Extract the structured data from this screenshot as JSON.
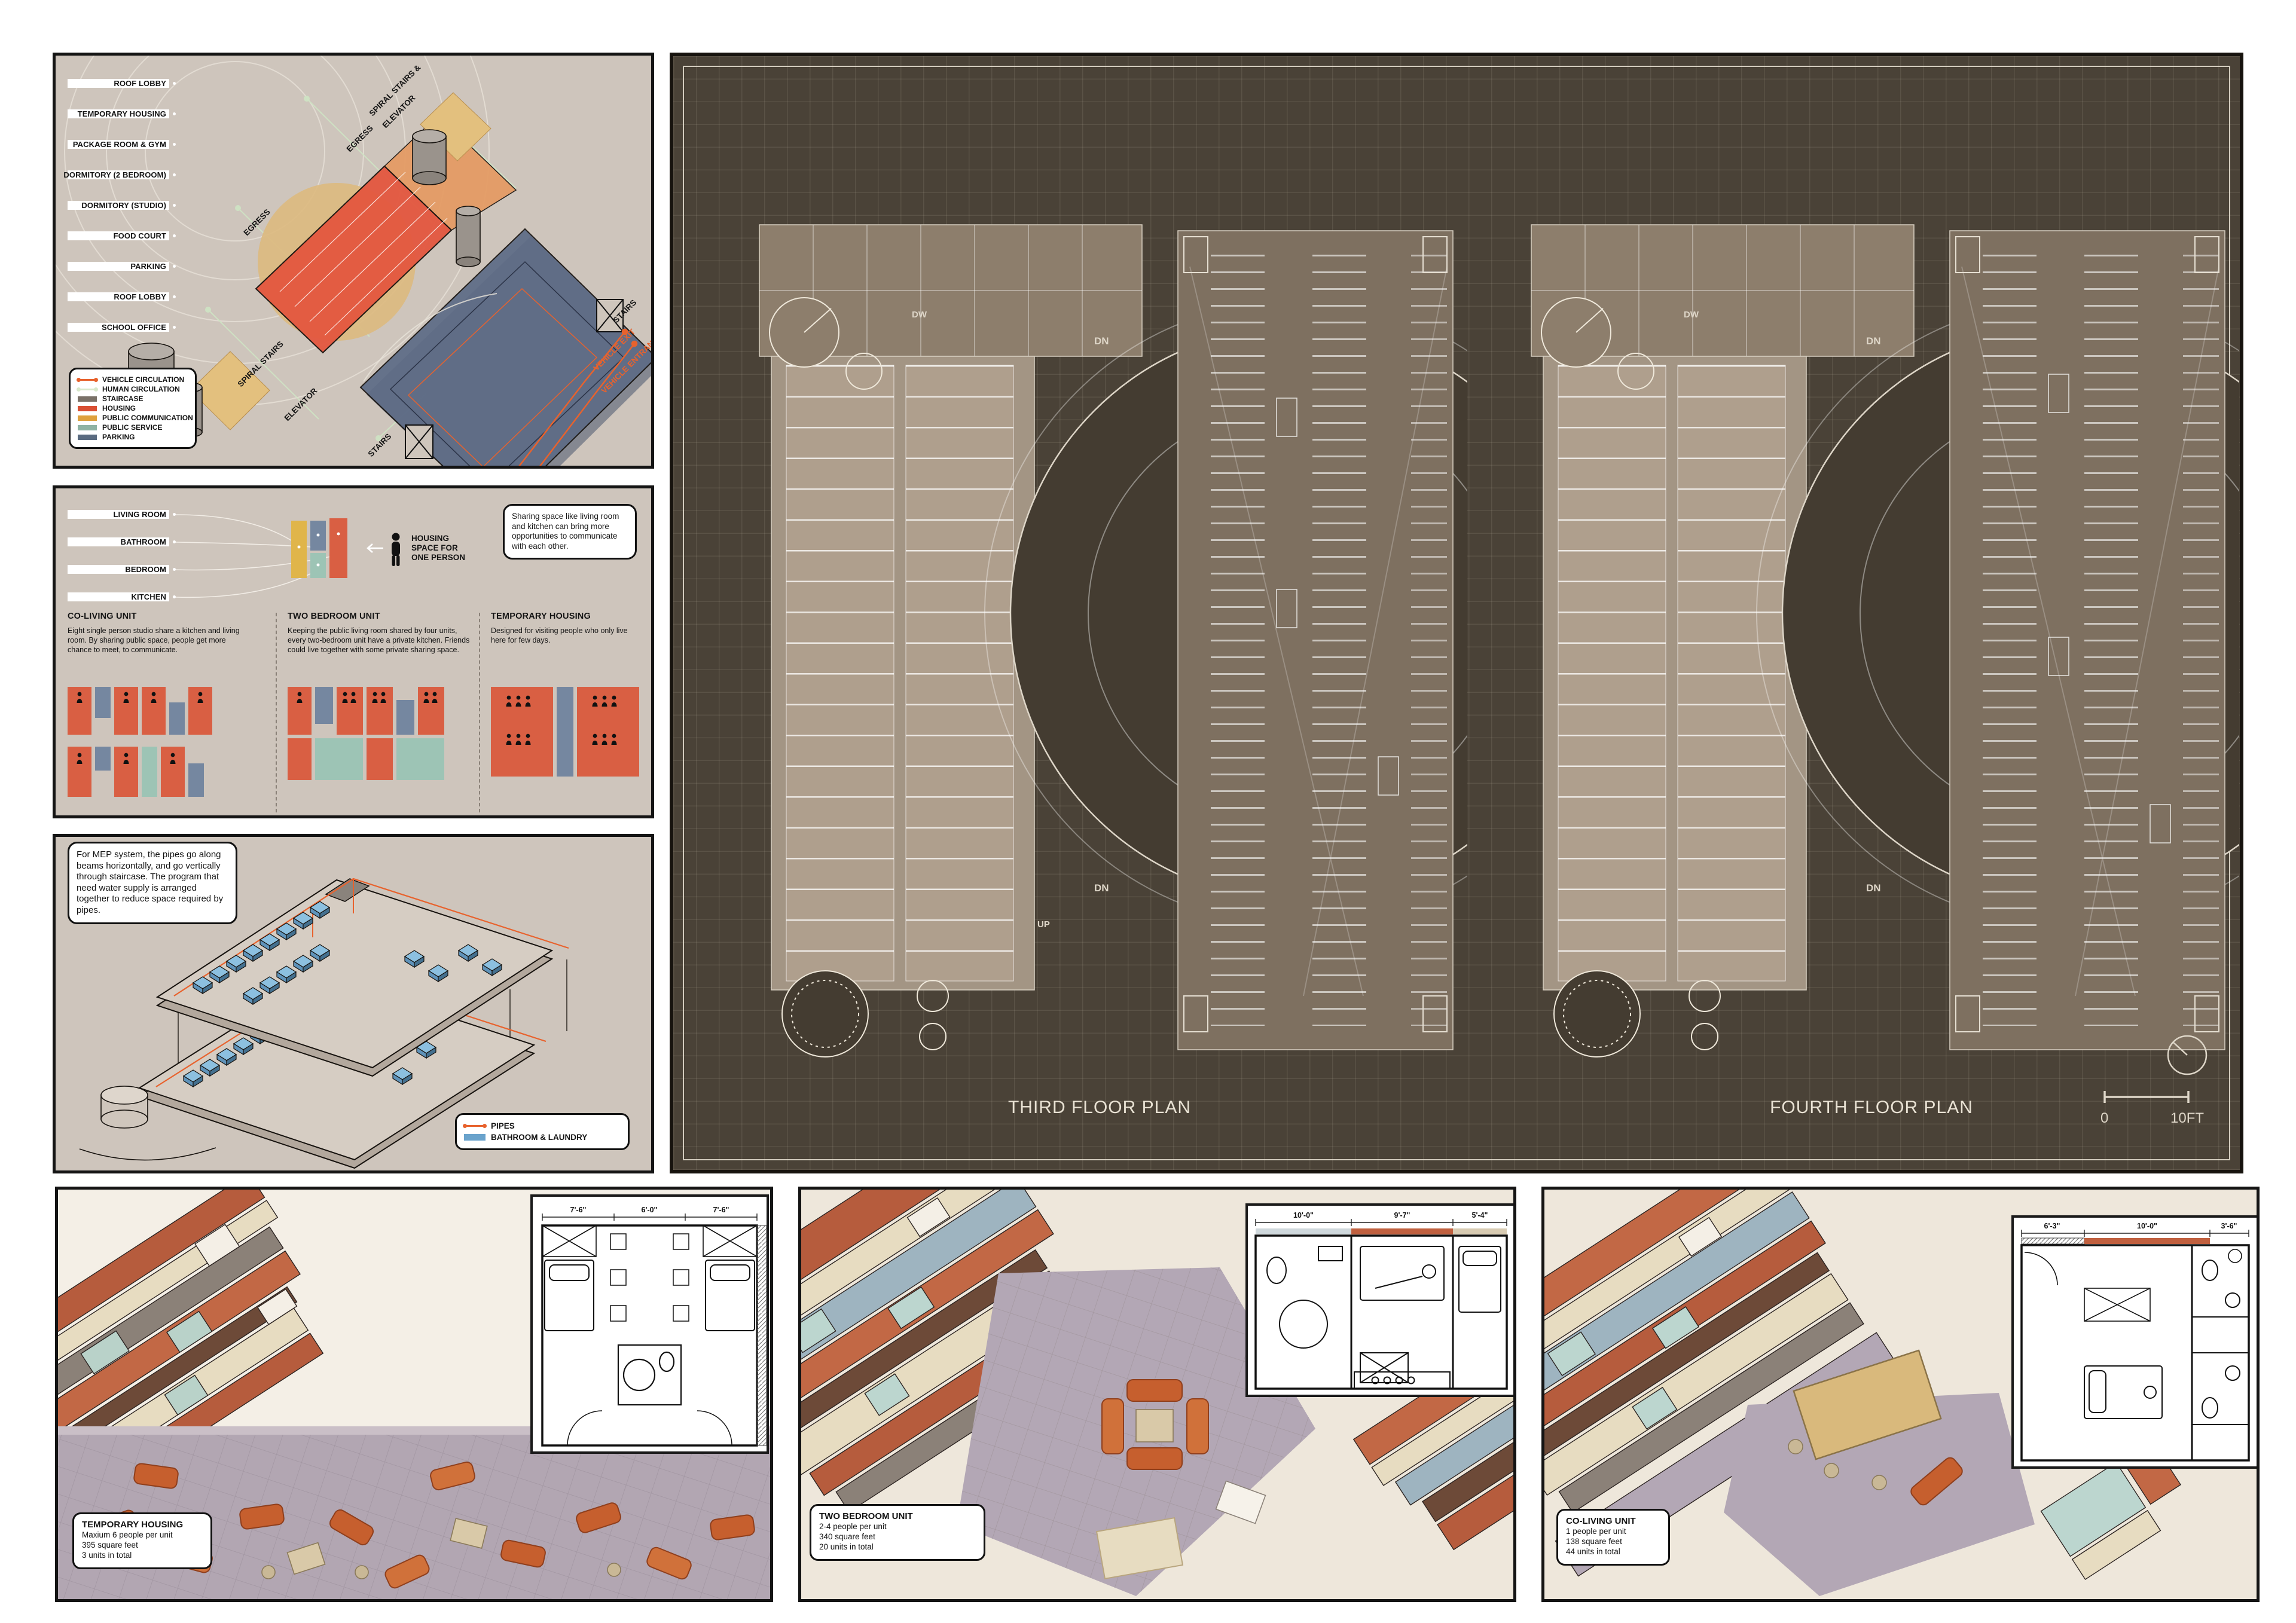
{
  "panel_program": {
    "labels": [
      "ROOF LOBBY",
      "TEMPORARY HOUSING",
      "PACKAGE ROOM & GYM",
      "DORMITORY (2 BEDROOM)",
      "DORMITORY (STUDIO)",
      "FOOD COURT",
      "PARKING",
      "ROOF LOBBY",
      "SCHOOL OFFICE"
    ],
    "axon_labels": {
      "spiral_top_1": "SPIRAL STAIRS &",
      "spiral_top_2": "ELEVATOR",
      "egress_top": "EGRESS",
      "egress_left": "EGRESS",
      "spiral_left": "SPIRAL STAIRS",
      "elevator": "ELEVATOR",
      "stairs_bottom": "STAIRS",
      "stairs_right": "STAIRS",
      "vehicle_exit": "VEHICLE EXIT",
      "vehicle_entrance": "VEHICLE ENTRANCE"
    },
    "legend": [
      {
        "label": "VEHICLE CIRCULATION",
        "color": "#e8622d"
      },
      {
        "label": "HUMAN CIRCULATION",
        "color": "#d8e8cb"
      },
      {
        "label": "STAIRCASE",
        "color": "#7a7168"
      },
      {
        "label": "HOUSING",
        "color": "#d94f33"
      },
      {
        "label": "PUBLIC COMMUNICATION",
        "color": "#dfa13d"
      },
      {
        "label": "PUBLIC SERVICE",
        "color": "#8fb3a4"
      },
      {
        "label": "PARKING",
        "color": "#5a6b80"
      }
    ]
  },
  "panel_units": {
    "room_labels": [
      "LIVING ROOM",
      "BATHROOM",
      "BEDROOM",
      "KITCHEN"
    ],
    "person_caption_lines": [
      "HOUSING",
      "SPACE FOR",
      "ONE PERSON"
    ],
    "callout": "Sharing space like living room and kitchen can bring more opportunities to communicate with each other.",
    "sections": [
      {
        "title": "CO-LIVING UNIT",
        "desc": "Eight single person studio share a kitchen and living room. By sharing public space, people get more chance to meet, to communicate."
      },
      {
        "title": "TWO BEDROOM UNIT",
        "desc": "Keeping the public living room shared by four units, every two-bedroom unit have a private kitchen. Friends could live together with some private sharing space."
      },
      {
        "title": "TEMPORARY HOUSING",
        "desc": "Designed for visiting people who only live here for few days."
      }
    ]
  },
  "panel_mep": {
    "callout": "For MEP system, the pipes go along beams horizontally, and go vertically through staircase. The program that need water supply is arranged together to reduce space required by pipes.",
    "legend": [
      {
        "label": "PIPES",
        "color": "#e8622d"
      },
      {
        "label": "BATHROOM & LAUNDRY",
        "color": "#6aa3cc"
      }
    ]
  },
  "board": {
    "titles": [
      "THIRD FLOOR PLAN",
      "FOURTH FLOOR PLAN"
    ],
    "scale": {
      "start": "0",
      "end": "10FT"
    },
    "annotations": {
      "dn": "DN",
      "up": "UP",
      "dw": "DW"
    }
  },
  "bottom_panels": [
    {
      "title": "TEMPORARY HOUSING",
      "lines": [
        "Maxium 6 people per unit",
        "395 square feet",
        "3 units in total"
      ],
      "dims": [
        "7'-6\"",
        "6'-0\"",
        "7'-6\""
      ]
    },
    {
      "title": "TWO BEDROOM UNIT",
      "lines": [
        "2-4 people per unit",
        "340 square feet",
        "20 units in total"
      ],
      "dims": [
        "10'-0\"",
        "9'-7\"",
        "5'-4\""
      ]
    },
    {
      "title": "CO-LIVING UNIT",
      "lines": [
        "1 people per unit",
        "138 square feet",
        "44 units in total"
      ],
      "dims": [
        "6'-3\"",
        "10'-0\"",
        "3'-6\""
      ]
    }
  ],
  "colors": {
    "panel_bg": "#cec5bc",
    "board_bg": "#4a4237",
    "housing_red": "#d94f33",
    "accent_orange": "#e8622d",
    "public_communication": "#dfa13d",
    "public_service": "#8fb3a4",
    "parking_blue": "#5a6b80",
    "staircase_gray": "#7a7168",
    "human_circulation": "#d8e8cb",
    "bathroom_blue": "#6aa3cc",
    "plan_beige": "#a39584",
    "title_text": "#e9e2d4",
    "sofa_orange": "#c65f2e",
    "plaza_mauve": "#b2a6b2"
  }
}
